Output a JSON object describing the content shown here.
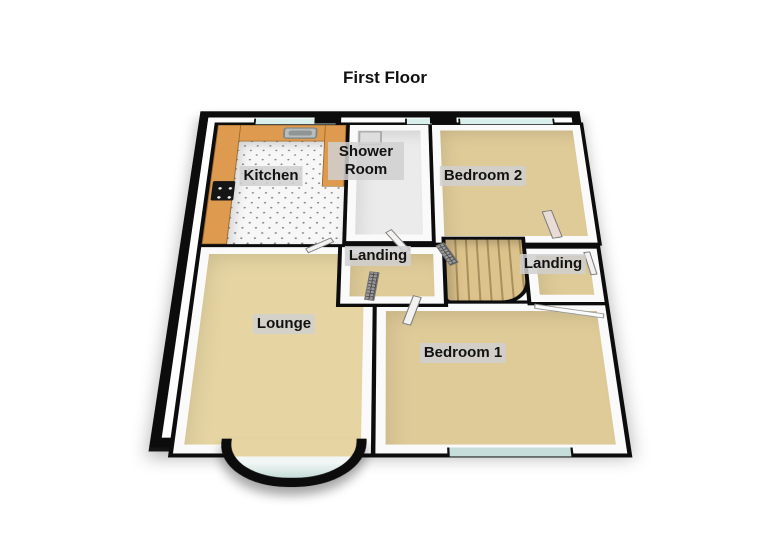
{
  "title": "First Floor",
  "rooms": {
    "kitchen": "Kitchen",
    "shower_room": "Shower Room",
    "bedroom2": "Bedroom 2",
    "landing_left": "Landing",
    "landing_right": "Landing",
    "lounge": "Lounge",
    "bedroom1": "Bedroom 1"
  },
  "colors": {
    "wall": "#0c0c0c",
    "wallface": "#fafafa",
    "carpet": "#dfcb98",
    "lounge-carpet": "#e6d5a3",
    "counter": "#de9b4f",
    "tread": "#dcc28b",
    "glass": "#d9efec",
    "bayglass": "#c6ddd9",
    "labelbg": "rgba(208,208,208,0.85)"
  }
}
